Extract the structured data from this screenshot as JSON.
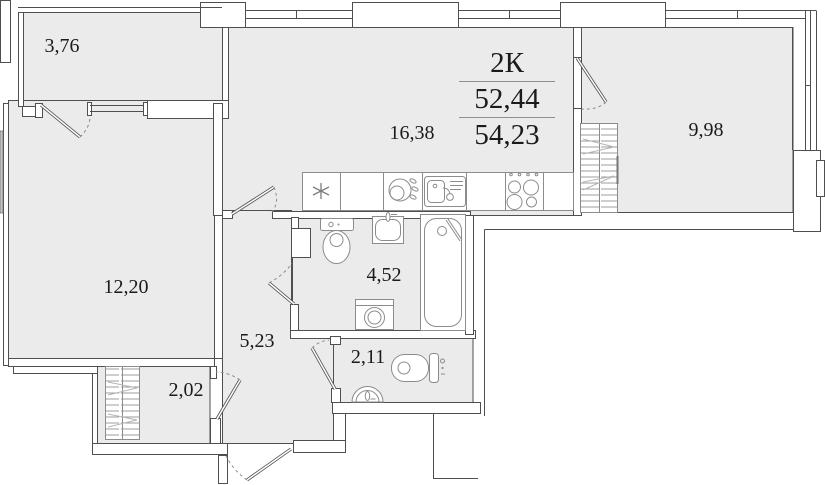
{
  "plan": {
    "title": {
      "type": "2К",
      "living_area": "52,44",
      "total_area": "54,23"
    },
    "rooms": [
      {
        "name": "balcony",
        "area": "3,76"
      },
      {
        "name": "living-room",
        "area": "12,20"
      },
      {
        "name": "kitchen-living-room",
        "area": "16,38"
      },
      {
        "name": "bedroom",
        "area": "9,98"
      },
      {
        "name": "bathroom",
        "area": "4,52"
      },
      {
        "name": "hallway",
        "area": "5,23"
      },
      {
        "name": "closet",
        "area": "2,02"
      },
      {
        "name": "wc",
        "area": "2,11"
      }
    ],
    "icons": [
      "refrigerator-icon",
      "dishwasher-icon",
      "kitchen-sink-icon",
      "stove-icon",
      "toilet-icon",
      "washbasin-icon",
      "bathtub-icon",
      "washing-machine-icon",
      "wc-toilet-icon",
      "corner-washbasin-icon",
      "wardrobe-icon",
      "door-swing-icon",
      "window-icon"
    ],
    "colors": {
      "floor_fill": "#ebebeb",
      "wall_line": "#4f4f4f",
      "fixture_line": "#8c8c8c",
      "text": "#1b1b1b"
    }
  }
}
